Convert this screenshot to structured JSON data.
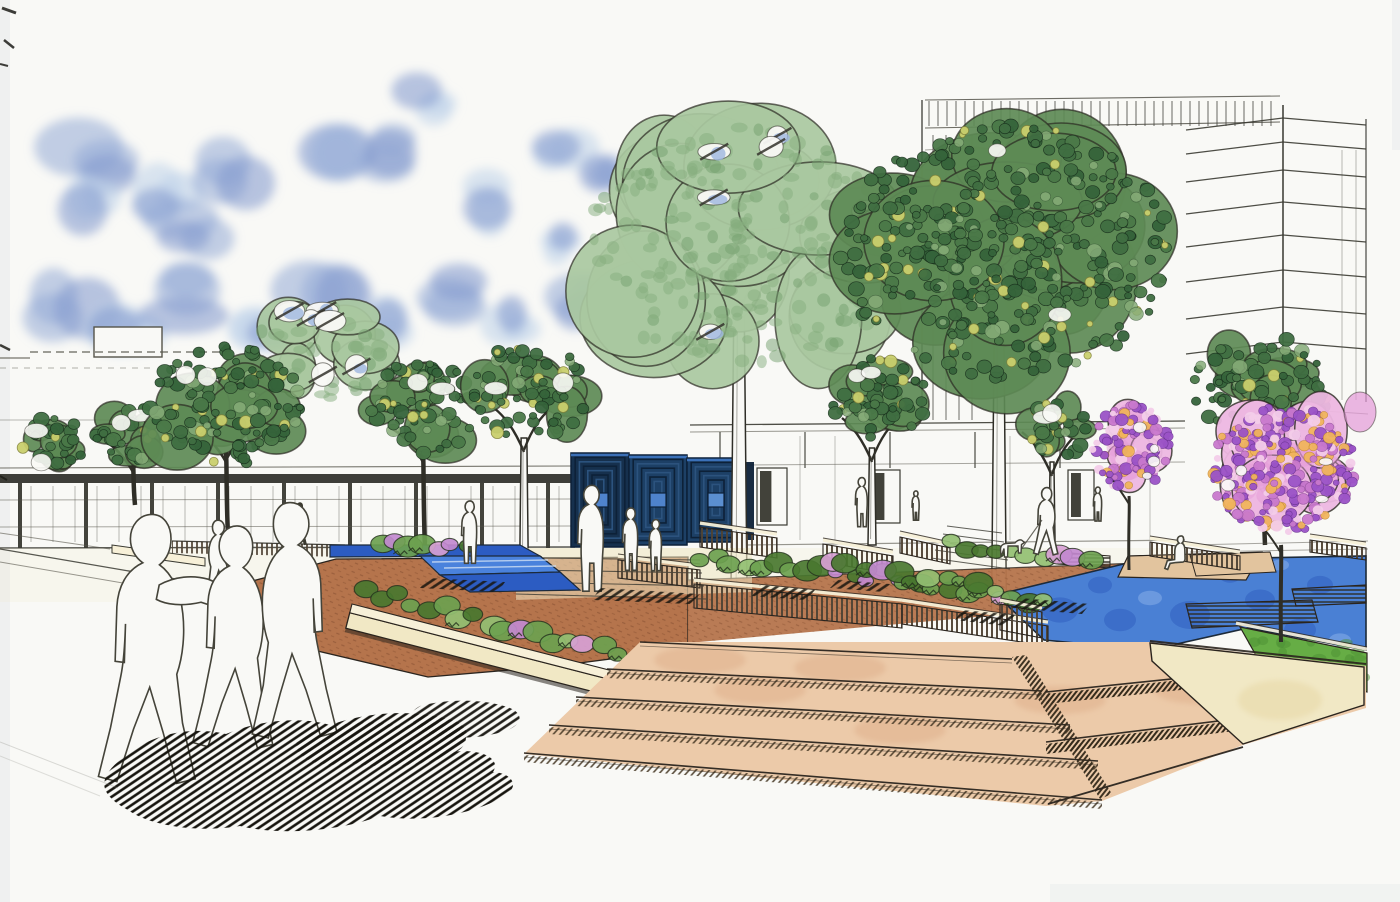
{
  "artwork": {
    "kind": "hand-drawn landscape architecture perspective rendering",
    "medium": "ink linework with watercolor marker washes on white paper"
  },
  "palette": {
    "paper": "#f9f9f6",
    "paper_shade": "#e7eaec",
    "ink": "#2b2a22",
    "line_light": "#55544a",
    "sky_blue": "#93a9d6",
    "sky_blue_light": "#bdd2ea",
    "sky_blue_deep": "#7f97cc",
    "pale_canopy": "#a9c8a0",
    "pale_canopy_dot": "#85ad7e",
    "dark_canopy": "#5d8a55",
    "dark_canopy_dot": "#3f6e41",
    "dark_canopy_deep": "#35633a",
    "canopy_yellow": "#c9cf6d",
    "canopy_highlight": "#86ac78",
    "trunk_dark": "#32312a",
    "bloom_base": "#edb7e2",
    "bloom_wash": "#e49ad8",
    "bloom_purple": "#9a52c6",
    "bloom_magenta": "#c878cc",
    "bloom_orange": "#f0b45c",
    "bloom_pink_light": "#f3cce9",
    "water_blue": "#4a80d4",
    "water_deep": "#2d5cbe",
    "water_light": "#82aae6",
    "runnel_blue": "#2c5cc2",
    "path_brown": "#b5744c",
    "path_brown_dark": "#8a5233",
    "step_peach": "#eccaa9",
    "step_peach_deep": "#ddae8a",
    "cream_wall": "#f1e8c5",
    "cream_cap": "#f7f0d8",
    "tan_deck": "#e2c49e",
    "lawn_green": "#66ad45",
    "lawn_deep": "#4c8f33",
    "shrub_green": "#6da14f",
    "shrub_deep": "#49772f",
    "shrub_light": "#93bf72",
    "flower_pink": "#d79fd4",
    "flower_lavender": "#c289cf",
    "hatch_dark": "#17150f",
    "stripe_brown": "#4f4334",
    "sculpt_navy": "#16304d",
    "sculpt_navy2": "#1d4066",
    "sculpt_blue": "#4f83cc",
    "sculpt_steel": "#0d2138"
  },
  "scene": {
    "clouds": [
      [
        105,
        165,
        45,
        0
      ],
      [
        168,
        192,
        40,
        1
      ],
      [
        238,
        168,
        36,
        0
      ],
      [
        88,
        212,
        34,
        1
      ],
      [
        198,
        232,
        40,
        0
      ],
      [
        330,
        138,
        40,
        1
      ],
      [
        382,
        152,
        30,
        0
      ],
      [
        432,
        102,
        26,
        1
      ],
      [
        482,
        200,
        30,
        1
      ],
      [
        70,
        300,
        40,
        0
      ],
      [
        128,
        326,
        36,
        1
      ],
      [
        205,
        300,
        46,
        0
      ],
      [
        264,
        332,
        32,
        1
      ],
      [
        330,
        300,
        42,
        0
      ],
      [
        394,
        320,
        30,
        1
      ],
      [
        452,
        292,
        34,
        0
      ],
      [
        518,
        320,
        28,
        1
      ],
      [
        560,
        142,
        28,
        1
      ],
      [
        600,
        172,
        26,
        0
      ],
      [
        574,
        300,
        32,
        0
      ],
      [
        614,
        330,
        24,
        1
      ],
      [
        548,
        246,
        26,
        1
      ],
      [
        660,
        204,
        20,
        0
      ],
      [
        698,
        228,
        16,
        1
      ]
    ],
    "trees": [
      {
        "id": "far-left",
        "style": "dark",
        "x": 55,
        "y": 445,
        "rx": 40,
        "ry": 32,
        "trunk": "none"
      },
      {
        "id": "left-small",
        "style": "dark",
        "x": 132,
        "y": 436,
        "rx": 42,
        "ry": 34,
        "trunk": "dark",
        "baseY": 505,
        "topY": 462
      },
      {
        "id": "left-back-pale",
        "style": "light",
        "x": 318,
        "y": 352,
        "rx": 74,
        "ry": 62,
        "trunk": "none"
      },
      {
        "id": "left-large",
        "style": "dark",
        "x": 225,
        "y": 405,
        "rx": 88,
        "ry": 70,
        "trunk": "dark",
        "baseY": 535,
        "topY": 452
      },
      {
        "id": "mid-left-a",
        "style": "dark",
        "x": 422,
        "y": 408,
        "rx": 62,
        "ry": 54,
        "trunk": "dark",
        "baseY": 548,
        "topY": 452
      },
      {
        "id": "mid-left-b",
        "style": "dark",
        "x": 530,
        "y": 392,
        "rx": 66,
        "ry": 56,
        "trunk": "white",
        "baseY": 585,
        "topY": 438,
        "w": 9
      },
      {
        "id": "center-pale-large",
        "style": "light",
        "x": 745,
        "y": 245,
        "rx": 195,
        "ry": 140,
        "trunk": "white",
        "baseY": 588,
        "topY": 300,
        "w": 16
      },
      {
        "id": "center-right-large",
        "style": "dark",
        "x": 1005,
        "y": 252,
        "rx": 188,
        "ry": 145,
        "trunk": "white",
        "baseY": 612,
        "topY": 330,
        "w": 15
      },
      {
        "id": "mid-right-a",
        "style": "dark",
        "x": 878,
        "y": 398,
        "rx": 56,
        "ry": 46,
        "trunk": "white",
        "baseY": 545,
        "topY": 448,
        "w": 8
      },
      {
        "id": "mid-right-b",
        "style": "dark",
        "x": 1058,
        "y": 428,
        "rx": 40,
        "ry": 32,
        "trunk": "white",
        "baseY": 540,
        "topY": 462,
        "w": 6
      },
      {
        "id": "right-green",
        "style": "dark",
        "x": 1262,
        "y": 388,
        "rx": 78,
        "ry": 60,
        "trunk": "dark",
        "baseY": 545,
        "topY": 452
      }
    ],
    "flowering_trees": [
      {
        "id": "flowering-small",
        "x": 1131,
        "y": 447,
        "rx": 46,
        "ry": 52,
        "baseY": 570,
        "topY": 496
      },
      {
        "id": "flowering-large",
        "x": 1283,
        "y": 468,
        "rx": 86,
        "ry": 76,
        "baseY": 642,
        "topY": 545
      }
    ],
    "people": [
      {
        "pose": "walk",
        "x": 300,
        "y": 546,
        "h": 46,
        "tone": "dark",
        "flip": false
      },
      {
        "pose": "walk",
        "x": 218,
        "y": 600,
        "h": 84,
        "tone": "outline",
        "flip": true
      },
      {
        "pose": "stand",
        "x": 470,
        "y": 565,
        "h": 66,
        "tone": "outline",
        "flip": false
      },
      {
        "pose": "stand",
        "x": 592,
        "y": 594,
        "h": 112,
        "tone": "outline",
        "flip": false
      },
      {
        "pose": "stand",
        "x": 631,
        "y": 572,
        "h": 66,
        "tone": "outline",
        "flip": false
      },
      {
        "pose": "stand",
        "x": 656,
        "y": 572,
        "h": 54,
        "tone": "outline",
        "flip": false
      },
      {
        "pose": "stand",
        "x": 862,
        "y": 528,
        "h": 52,
        "tone": "outline",
        "flip": false
      },
      {
        "pose": "stand",
        "x": 916,
        "y": 521,
        "h": 31,
        "tone": "outline",
        "flip": false
      },
      {
        "pose": "walk",
        "x": 1047,
        "y": 556,
        "h": 72,
        "tone": "outline",
        "flip": false
      },
      {
        "pose": "stand",
        "x": 1098,
        "y": 522,
        "h": 36,
        "tone": "outline",
        "flip": false
      },
      {
        "pose": "sit",
        "x": 1180,
        "y": 570,
        "h": 55,
        "tone": "outline",
        "flip": false
      },
      {
        "pose": "walk-arm",
        "x": 152,
        "y": 788,
        "h": 288,
        "tone": "outline",
        "flip": false
      },
      {
        "pose": "walk",
        "x": 237,
        "y": 752,
        "h": 238,
        "tone": "outline",
        "flip": false
      },
      {
        "pose": "walk",
        "x": 290,
        "y": 742,
        "h": 252,
        "tone": "outline",
        "flip": true
      }
    ],
    "dog": {
      "x": 1010,
      "y": 557,
      "h": 16
    }
  }
}
